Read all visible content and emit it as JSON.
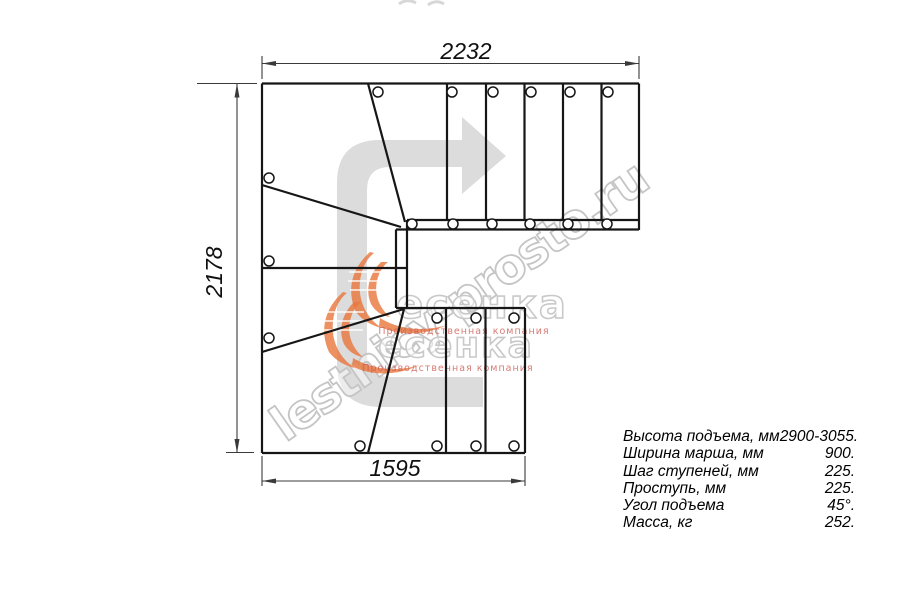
{
  "drawing": {
    "type": "stair-plan-top-view",
    "dimensions": {
      "top": "2232",
      "left": "2178",
      "bottom": "1595"
    },
    "direction_arrow_icon": "u-turn-right-arrow"
  },
  "watermark": {
    "site_text": "lestnicy-prosto.ru",
    "brand_text": "есенка",
    "brand_subtitle": "Производственная компания",
    "colors": {
      "outline_gray": "#c5c5c5",
      "subtitle_red": "#cd5b52",
      "swoosh_orange": "#e8763c",
      "arrow_gray": "#d9d9d9"
    }
  },
  "spec_table": {
    "rows": [
      {
        "label": "Высота подъема, мм",
        "value": "2900-3055."
      },
      {
        "label": "Ширина марша, мм",
        "value": "900."
      },
      {
        "label": "Шаг ступеней, мм",
        "value": "225."
      },
      {
        "label": "Проступь, мм",
        "value": "225."
      },
      {
        "label": "Угол подъема",
        "value": "45°."
      },
      {
        "label": "Масса, кг",
        "value": "252."
      }
    ]
  }
}
